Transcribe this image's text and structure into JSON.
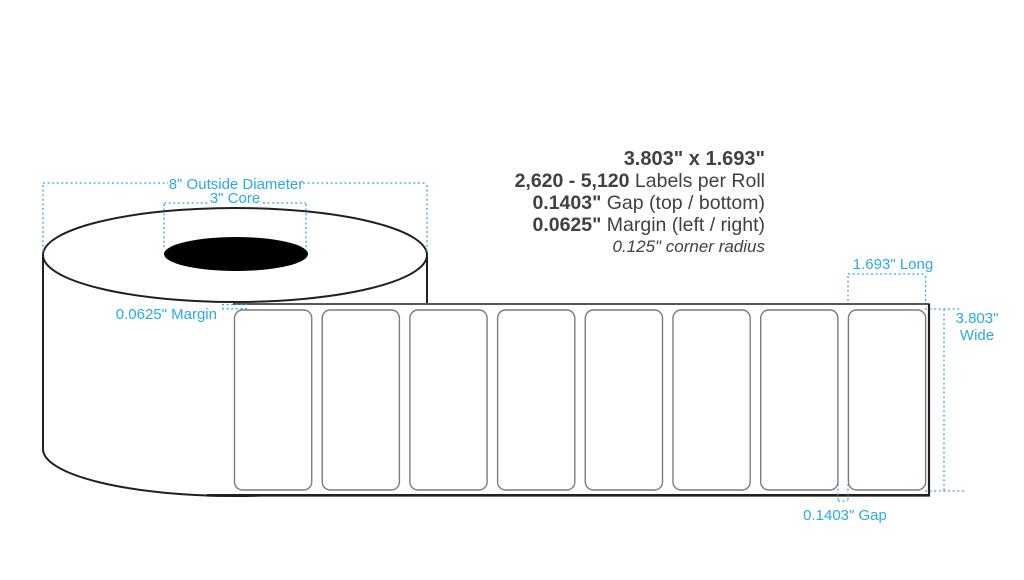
{
  "diagram": {
    "title_note": "label roll dimension diagram",
    "colors": {
      "dimension_blue": "#29ABE2",
      "spec_text_dark": "#414042",
      "outline_ink": "#231F20",
      "label_outline_gray": "#7C7C7C",
      "core_fill": "#000000"
    },
    "specs": {
      "size": "3.803\" x 1.693\"",
      "labels_per_roll_value": "2,620 - 5,120",
      "labels_per_roll_suffix": " Labels per Roll",
      "gap_value": "0.1403\"",
      "gap_suffix": " Gap (top / bottom)",
      "margin_value": "0.0625\"",
      "margin_suffix": " Margin (left / right)",
      "corner_radius_note": "0.125\" corner radius"
    },
    "dimensions": {
      "outside_diameter": "8\" Outside Diameter",
      "core": "3\" Core",
      "left_margin": "0.0625\" Margin",
      "label_length": "1.693\" Long",
      "label_width_line1": "3.803\"",
      "label_width_line2": "Wide",
      "gap": "0.1403\" Gap"
    },
    "roll": {
      "labels_visible": 8
    }
  }
}
